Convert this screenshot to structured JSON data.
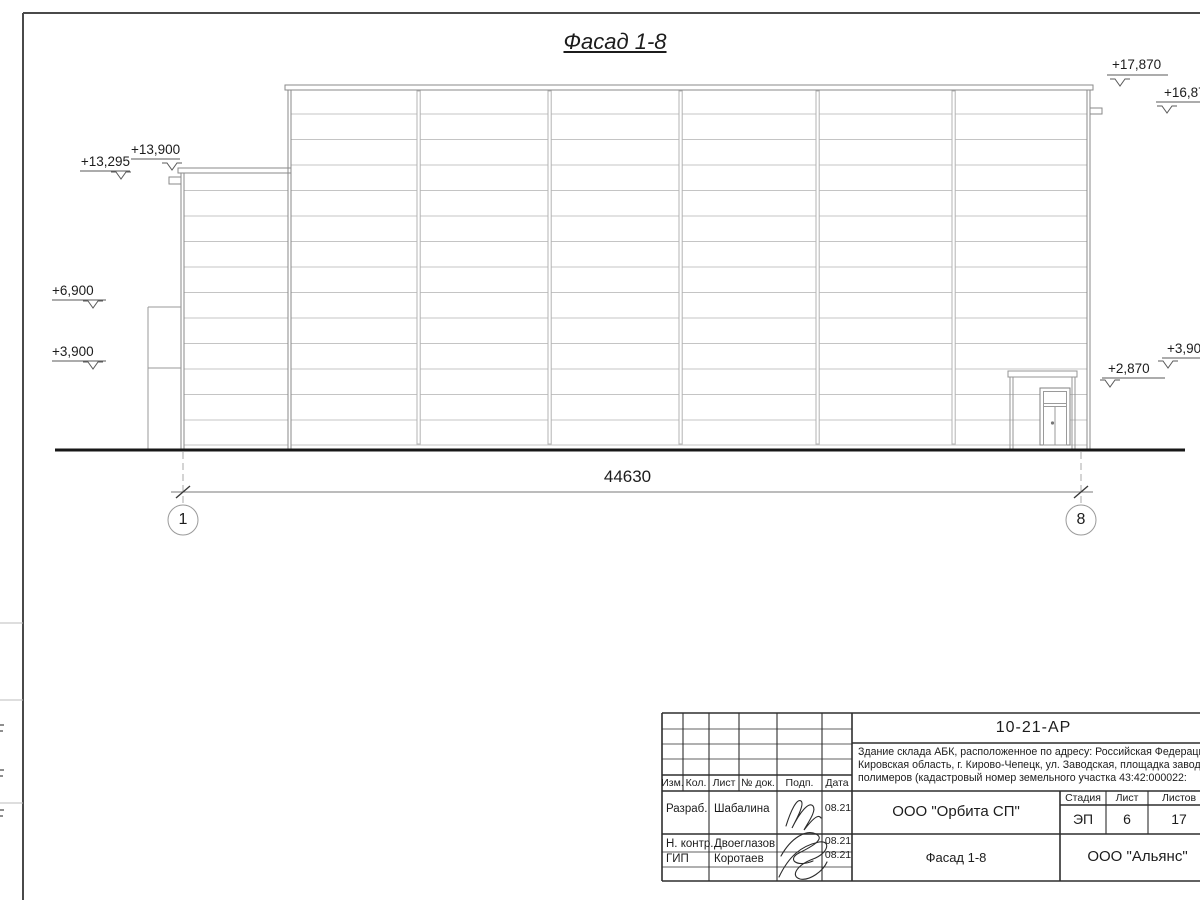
{
  "drawing": {
    "title": "Фасад 1-8",
    "elevation_marks": [
      {
        "text": "+13,295"
      },
      {
        "text": "+13,900"
      },
      {
        "text": "+6,900"
      },
      {
        "text": "+3,900"
      },
      {
        "text": "+17,870"
      },
      {
        "text": "+16,870"
      },
      {
        "text": "+2,870"
      },
      {
        "text": "+3,900"
      }
    ],
    "dimension_total": "44630",
    "axis_left": "1",
    "axis_right": "8"
  },
  "title_block": {
    "doc_number": "10-21-АР",
    "description_line1": "Здание склада АБК, расположенное по адресу: Российская Федерация,",
    "description_line2": "Кировская область, г. Кирово-Чепецк, ул. Заводская, площадка завода",
    "description_line3": "полимеров (кадастровый номер земельного участка 43:42:000022:",
    "header_columns": [
      "Изм.",
      "Кол.",
      "Лист",
      "№ док.",
      "Подп.",
      "Дата"
    ],
    "signers": [
      {
        "role": "Разраб.",
        "name": "Шабалина",
        "date": "08.21"
      },
      {
        "role": "Н. контр.",
        "name": "Двоеглазов",
        "date": "08.21"
      },
      {
        "role": "ГИП",
        "name": "Коротаев",
        "date": "08.21"
      }
    ],
    "company": "ООО \"Орбита СП\"",
    "stage_label": "Стадия",
    "sheet_label": "Лист",
    "sheets_label": "Листов",
    "stage": "ЭП",
    "sheet_number": "6",
    "sheets_total": "17",
    "drawing_name": "Фасад 1-8",
    "organization": "ООО \"Альянс\""
  }
}
